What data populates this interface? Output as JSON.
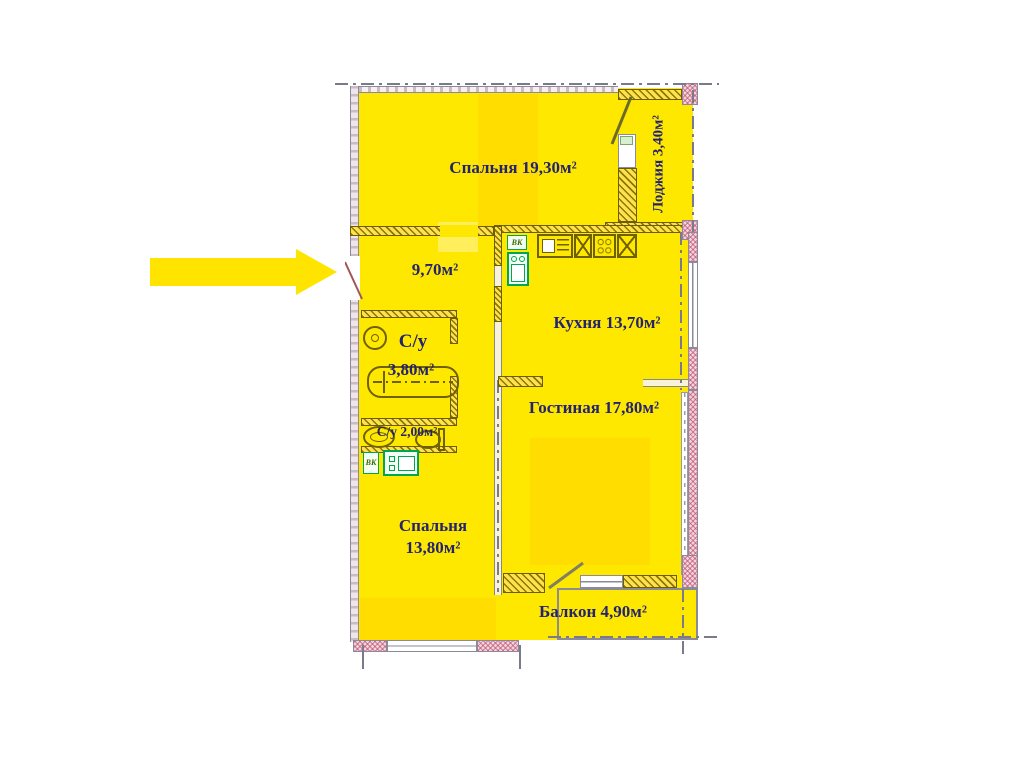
{
  "rooms": {
    "bedroom_top": {
      "label": "Спальня 19,30м²"
    },
    "loggia": {
      "label": "Лоджия 3,40м²"
    },
    "hall": {
      "label": "9,70м²"
    },
    "kitchen": {
      "label": "Кухня 13,70м²"
    },
    "bathroom_large": {
      "line1": "С/у",
      "line2": "3,80м²"
    },
    "bathroom_small": {
      "label": "С/у 2,00м²"
    },
    "living": {
      "label": "Гостиная 17,80м²"
    },
    "bedroom_bottom": {
      "line1": "Спальня",
      "line2": "13,80м²"
    },
    "balcony": {
      "label": "Балкон 4,90м²"
    }
  },
  "annotations": {
    "vk_kitchen": "ВК",
    "vk_laundry": "ВК"
  },
  "arrow": {
    "direction": "right",
    "color": "#ffe400"
  },
  "colors": {
    "room_fill": "#ffe800",
    "room_fill_deep": "#ffd900",
    "wall_hatch_olive": "#8a7800",
    "wall_masonry_pink": "#be4664",
    "label_text": "#232370",
    "fixture_green": "#00a651",
    "axis_gray": "#7a7a8c"
  }
}
